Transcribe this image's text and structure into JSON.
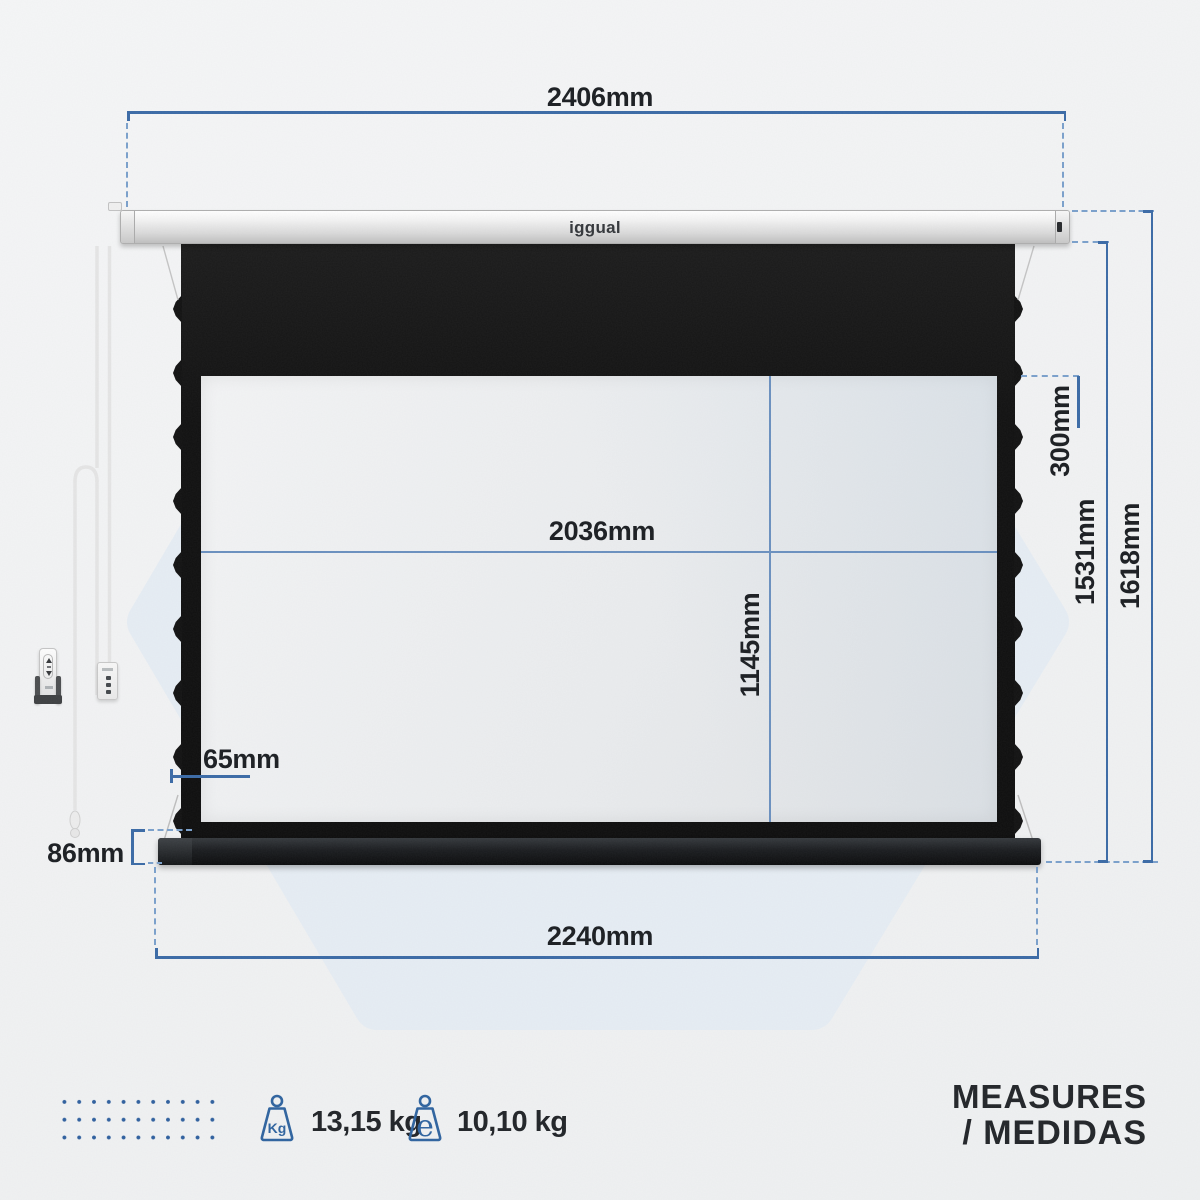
{
  "brand": {
    "logo_text": "iggual"
  },
  "dimensions": {
    "case_width": "2406mm",
    "viewing_width": "2036mm",
    "viewing_height": "1145mm",
    "top_drop": "300mm",
    "fabric_height": "1531mm",
    "total_height": "1618mm",
    "side_border": "65mm",
    "bottom_bar_height": "86mm",
    "bottom_width": "2240mm"
  },
  "footer": {
    "weights": [
      {
        "icon": "weight-kg-icon",
        "icon_text": "Kg",
        "value": "13,15 kg"
      },
      {
        "icon": "weight-estimated-icon",
        "icon_text": "e",
        "value": "10,10 kg"
      }
    ],
    "title_line1": "MEASURES",
    "title_line2": "/ MEDIDAS"
  },
  "colors": {
    "dimension_line": "#3a6aa6",
    "dimension_line_light": "#6a90bf",
    "dimension_dashed": "#7aa0cc",
    "accent_blue": "#2e5f9e",
    "screen_fabric": "#141414",
    "watermark_hex": "#e6edf4",
    "background": "#f2f3f4"
  }
}
